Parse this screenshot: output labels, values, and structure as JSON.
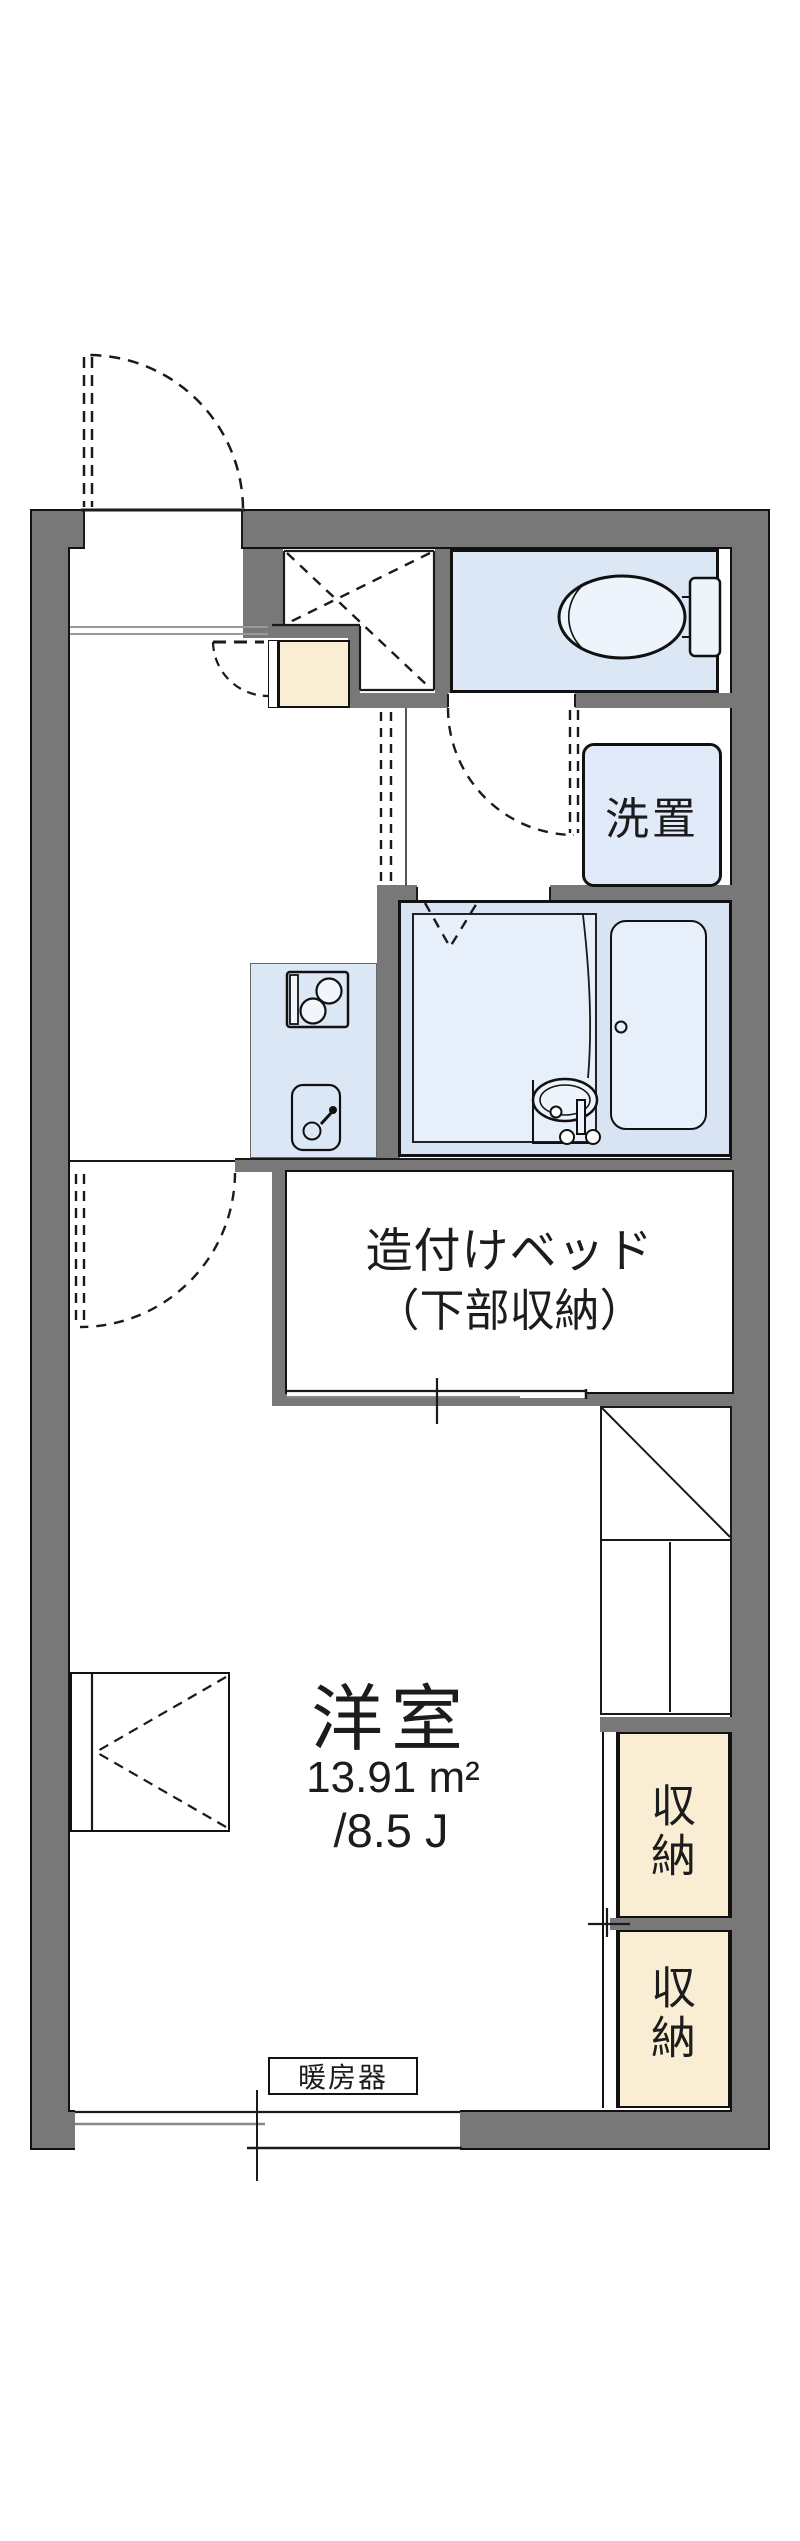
{
  "floorplan": {
    "labels": {
      "washer": "洗置",
      "bed_line1": "造付けベッド",
      "bed_line2": "（下部収納）",
      "room_name": "洋室",
      "room_area": "13.91 m²",
      "room_tatami": "/8.5 J",
      "storage_upper": "収納",
      "storage_lower": "収納",
      "heater": "暖房器"
    },
    "colors": {
      "wall": "#787878",
      "water_area_fill": "#dce7f6",
      "fixture_fill": "#e7effa",
      "storage_fill": "#f9edd3",
      "line": "#1a1a1a"
    }
  }
}
